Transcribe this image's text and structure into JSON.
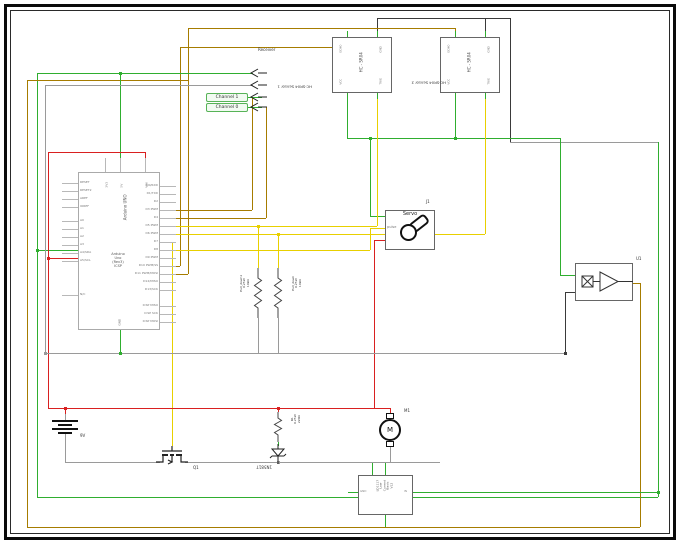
{
  "palette": {
    "g": "#2fae2f",
    "y": "#e8d000",
    "b": "#a67c00",
    "r": "#d92020",
    "k": "#3a3a3a",
    "a": "#9a9a9a",
    "stub": "#b8b8b8"
  },
  "arduino": {
    "vertical_label": "Arduino UNO",
    "center_label": "Arduino\nUno\n(Rev3)\nICSP",
    "left_pins": [
      "RESET",
      "RESET2",
      "AREF",
      "IOREF",
      "A0",
      "A1",
      "A2",
      "A3",
      "A4/SDA",
      "A5/SCL",
      "N/C"
    ],
    "right_pins": [
      "D0/RXD",
      "D1/TXD",
      "D2",
      "D3 PWM",
      "D4",
      "D5 PWM",
      "D6 PWM",
      "D7",
      "D8",
      "D9 PWM",
      "D10 PWM/SS",
      "D11 PWM/MOSI",
      "D12/MISO",
      "D13/SCK",
      "ICSP MISO",
      "ICSP SCK",
      "ICSP MOSI"
    ],
    "top_pins": [
      "3V3",
      "5V",
      "VIN"
    ],
    "bottom_pins": [
      "GND"
    ]
  },
  "sensor1": {
    "label": "Receiver",
    "rotated_label": "HC-SR04 Sensor 1",
    "channels": [
      "Channel 1",
      "Channel 0"
    ]
  },
  "sensor2": {
    "rotated_label": "HC-SR04 Sensor 2",
    "center_label": "HC - SR04",
    "pin_labels": [
      "ECHO",
      "GND",
      "VCC",
      "TRIG"
    ]
  },
  "servo": {
    "ref": "J1",
    "title": "Servo",
    "pin": "pulse"
  },
  "amplifier": {
    "ref": "U1"
  },
  "resistors": {
    "pulldown1": "Pull_down1\n0.25W\n10kΩ",
    "pulldown2": "Pull_down\n0.25W\n10kΩ",
    "r1": "R1\n0.25W\n220Ω"
  },
  "battery": {
    "label": "9V"
  },
  "mosfet": {
    "ref": "Q1"
  },
  "diode": {
    "part": "1N5817"
  },
  "motor": {
    "ref": "M1",
    "symbol": "M"
  },
  "regulator": {
    "text": "LD1117\nLow\nCurrent\nBasic\nV12",
    "pin_left": "GND",
    "pin_right": "IN"
  },
  "wires": [
    [
      37,
      73,
      37,
      497,
      "g"
    ],
    [
      37,
      497,
      658,
      497,
      "g"
    ],
    [
      658,
      142,
      658,
      497,
      "g"
    ],
    [
      510,
      142,
      658,
      142,
      "a"
    ],
    [
      510,
      18,
      510,
      142,
      "k"
    ],
    [
      377,
      18,
      510,
      18,
      "k"
    ],
    [
      377,
      18,
      377,
      37,
      "k"
    ],
    [
      485,
      18,
      485,
      37,
      "k"
    ],
    [
      27,
      80,
      27,
      527,
      "b"
    ],
    [
      27,
      527,
      640,
      527,
      "b"
    ],
    [
      640,
      283,
      640,
      527,
      "b"
    ],
    [
      633,
      283,
      640,
      283,
      "b"
    ],
    [
      27,
      80,
      188,
      80,
      "b"
    ],
    [
      188,
      28,
      188,
      274,
      "b"
    ],
    [
      188,
      28,
      455,
      28,
      "b"
    ],
    [
      455,
      28,
      455,
      37,
      "b"
    ],
    [
      166,
      274,
      188,
      274,
      "b"
    ],
    [
      180,
      47,
      347,
      47,
      "b"
    ],
    [
      347,
      37,
      347,
      47,
      "b"
    ],
    [
      180,
      47,
      180,
      266,
      "b"
    ],
    [
      166,
      266,
      180,
      266,
      "b"
    ],
    [
      252,
      97,
      252,
      210,
      "b"
    ],
    [
      166,
      210,
      252,
      210,
      "b"
    ],
    [
      266,
      107,
      266,
      218,
      "b"
    ],
    [
      166,
      218,
      266,
      218,
      "b"
    ],
    [
      37,
      73,
      253,
      73,
      "g"
    ],
    [
      120,
      73,
      120,
      172,
      "g"
    ],
    [
      120,
      330,
      120,
      353,
      "g"
    ],
    [
      37,
      250,
      78,
      250,
      "g"
    ],
    [
      347,
      93,
      347,
      138,
      "g"
    ],
    [
      455,
      93,
      455,
      138,
      "g"
    ],
    [
      347,
      138,
      560,
      138,
      "g"
    ],
    [
      560,
      138,
      560,
      275,
      "g"
    ],
    [
      560,
      275,
      575,
      275,
      "g"
    ],
    [
      370,
      138,
      370,
      216,
      "g"
    ],
    [
      370,
      216,
      385,
      216,
      "g"
    ],
    [
      248,
      97,
      262,
      97,
      "g"
    ],
    [
      248,
      107,
      262,
      107,
      "g"
    ],
    [
      372,
      462,
      372,
      475,
      "g"
    ],
    [
      385,
      462,
      385,
      475,
      "g"
    ],
    [
      348,
      492,
      358,
      492,
      "g"
    ],
    [
      413,
      492,
      658,
      492,
      "g"
    ],
    [
      385,
      515,
      385,
      527,
      "g"
    ],
    [
      278,
      442,
      278,
      446,
      "g"
    ],
    [
      166,
      226,
      377,
      226,
      "y"
    ],
    [
      377,
      93,
      377,
      226,
      "y"
    ],
    [
      258,
      226,
      258,
      268,
      "y"
    ],
    [
      166,
      234,
      485,
      234,
      "y"
    ],
    [
      485,
      93,
      485,
      234,
      "y"
    ],
    [
      278,
      234,
      278,
      268,
      "y"
    ],
    [
      166,
      250,
      370,
      250,
      "y"
    ],
    [
      370,
      228,
      370,
      250,
      "y"
    ],
    [
      370,
      228,
      385,
      228,
      "y"
    ],
    [
      166,
      242,
      172,
      242,
      "y"
    ],
    [
      172,
      242,
      172,
      446,
      "y"
    ],
    [
      48,
      152,
      48,
      408,
      "r"
    ],
    [
      48,
      152,
      145,
      152,
      "r"
    ],
    [
      145,
      152,
      145,
      172,
      "r"
    ],
    [
      48,
      408,
      390,
      408,
      "r"
    ],
    [
      65,
      408,
      65,
      414,
      "r"
    ],
    [
      278,
      408,
      278,
      412,
      "r"
    ],
    [
      390,
      408,
      390,
      413,
      "r"
    ],
    [
      48,
      258,
      78,
      258,
      "r"
    ],
    [
      374,
      240,
      385,
      240,
      "r"
    ],
    [
      374,
      240,
      374,
      408,
      "r"
    ],
    [
      45,
      85,
      253,
      85,
      "a"
    ],
    [
      45,
      85,
      45,
      353,
      "a"
    ],
    [
      45,
      353,
      565,
      353,
      "a"
    ],
    [
      258,
      318,
      258,
      353,
      "a"
    ],
    [
      278,
      318,
      278,
      353,
      "a"
    ],
    [
      565,
      292,
      565,
      353,
      "k"
    ],
    [
      565,
      292,
      575,
      292,
      "k"
    ],
    [
      65,
      414,
      65,
      420,
      "a"
    ],
    [
      65,
      432,
      65,
      462,
      "a"
    ],
    [
      65,
      462,
      160,
      462,
      "a"
    ],
    [
      185,
      462,
      278,
      462,
      "a"
    ],
    [
      278,
      462,
      440,
      462,
      "a"
    ],
    [
      390,
      447,
      390,
      462,
      "a"
    ]
  ],
  "dots": [
    [
      120,
      73,
      "g"
    ],
    [
      370,
      138,
      "g"
    ],
    [
      455,
      138,
      "g"
    ],
    [
      37,
      250,
      "g"
    ],
    [
      120,
      353,
      "g"
    ],
    [
      658,
      492,
      "g"
    ],
    [
      65,
      408,
      "r"
    ],
    [
      278,
      408,
      "r"
    ],
    [
      48,
      258,
      "r"
    ],
    [
      258,
      226,
      "y"
    ],
    [
      278,
      234,
      "y"
    ],
    [
      45,
      353,
      "a"
    ],
    [
      278,
      462,
      "a"
    ],
    [
      565,
      353,
      "k"
    ]
  ]
}
